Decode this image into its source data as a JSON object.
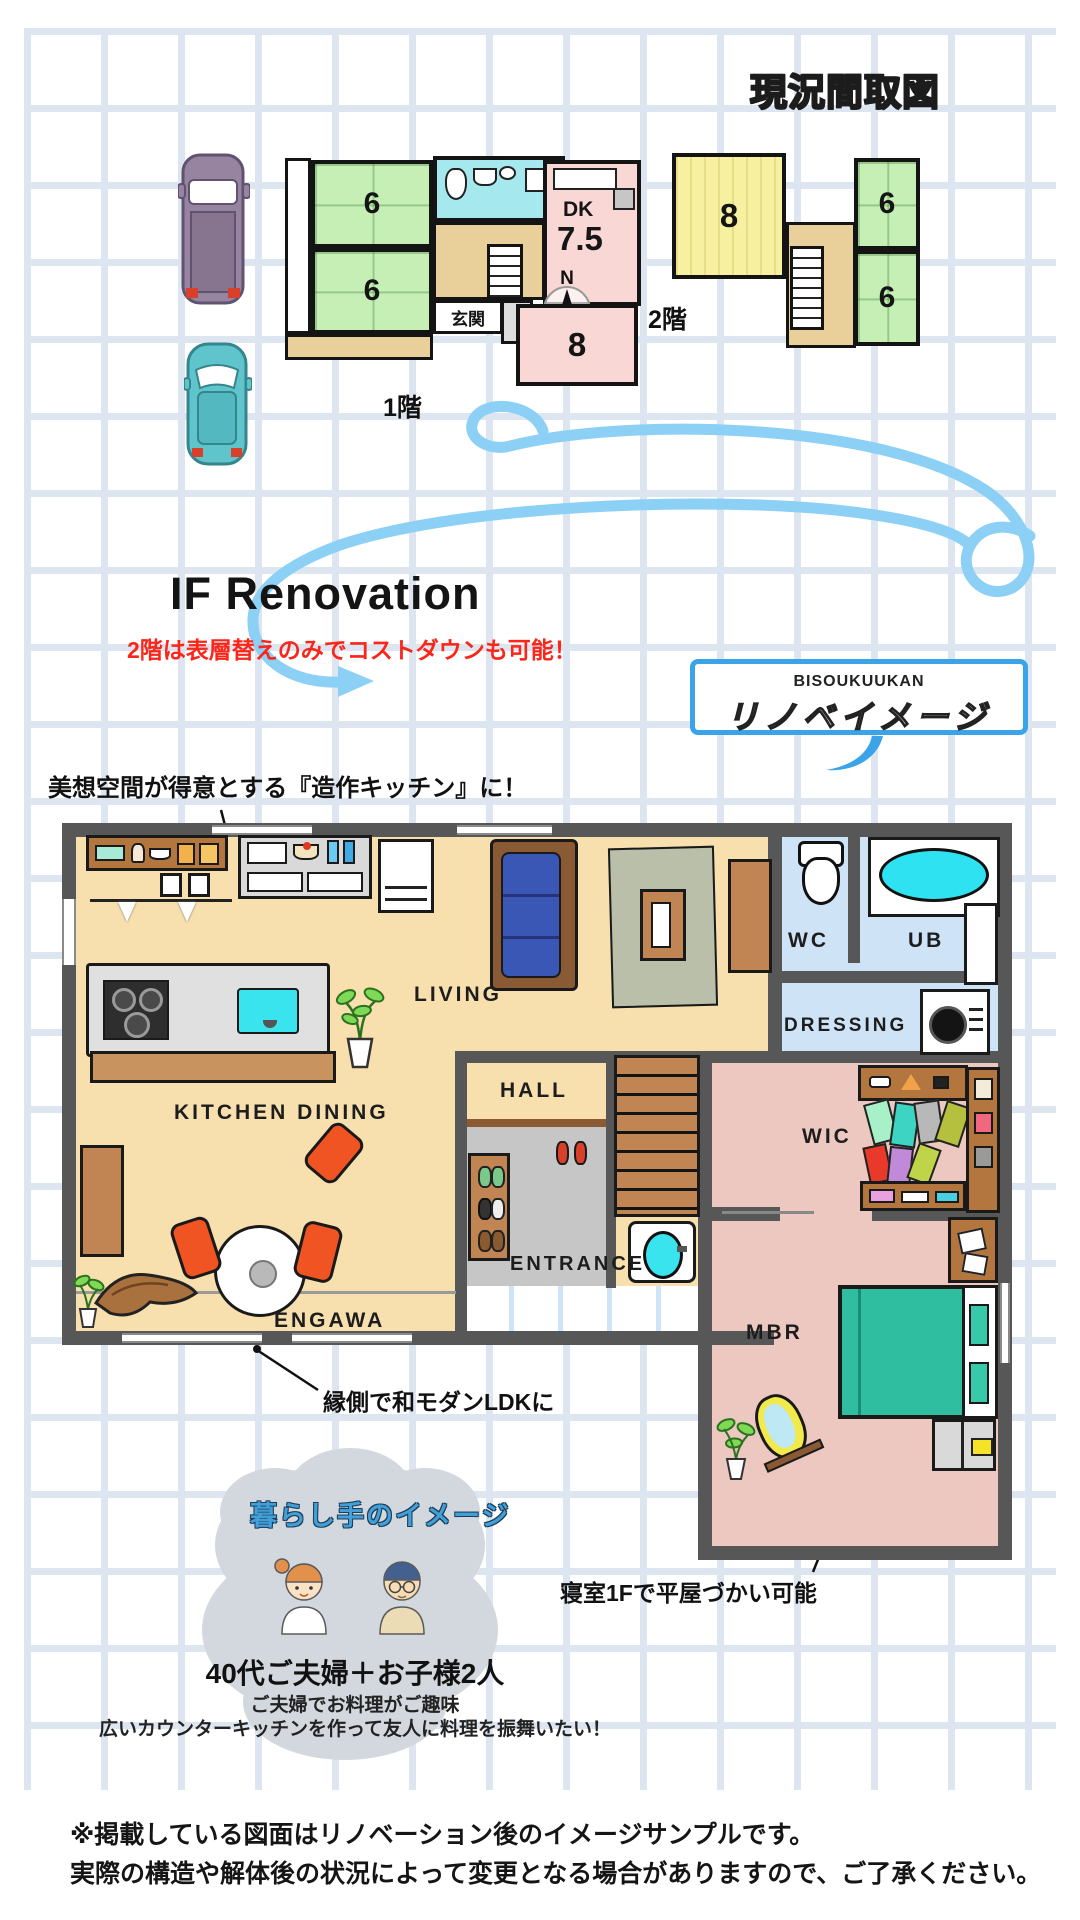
{
  "page": {
    "title": "現況間取図"
  },
  "current_plans": {
    "floor1": {
      "caption": "1階",
      "tatami_top": "6",
      "tatami_bottom": "6",
      "dk_label": "DK",
      "dk_size": "7.5",
      "washitsu8": "8",
      "genkan": "玄関"
    },
    "floor2": {
      "caption": "2階",
      "room8": "8",
      "room6_top": "6",
      "room6_bottom": "6"
    },
    "compass": "N"
  },
  "renovation_header": {
    "headline": "IF Renovation",
    "cost_note": "2階は表層替えのみでコストダウンも可能！",
    "badge_brand": "BISOUKUUKAN",
    "badge_title": "リノベイメージ"
  },
  "annotations": {
    "kitchen": "美想空間が得意とする『造作キッチン』に！",
    "engawa": "縁側で和モダンLDKに",
    "bedroom": "寝室1Fで平屋づかい可能"
  },
  "renovated_plan": {
    "living": "LIVING",
    "kitchen_dining": "KITCHEN DINING",
    "hall": "HALL",
    "entrance": "ENTRANCE",
    "engawa": "ENGAWA",
    "wc": "WC",
    "ub": "UB",
    "dressing": "DRESSING",
    "wic": "WIC",
    "mbr": "MBR"
  },
  "resident_profile": {
    "cloud_title": "暮らし手のイメージ",
    "family": "40代ご夫婦＋お子様2人",
    "hobby": "ご夫婦でお料理がご趣味",
    "wish": "広いカウンターキッチンを作って友人に料理を振舞いたい！"
  },
  "disclaimer": {
    "line1": "※掲載している図面はリノベーション後のイメージサンプルです。",
    "line2": "実際の構造や解体後の状況によって変更となる場合がありますので、ご了承ください。"
  },
  "colors": {
    "grid": "#dde6f0",
    "tatami_green": "#c5efb5",
    "bath_cyan": "#a5e9ef",
    "room_pink": "#f8d7d5",
    "room_yellow": "#f6f0a0",
    "hall_tan": "#e9cf9a",
    "wall_dark": "#575757",
    "floor_cream": "#f8dfae",
    "floor_blue": "#cfe3f6",
    "floor_pink": "#ecc8c1",
    "floor_gray": "#c6c6c6",
    "accent_blue": "#3ba4e8",
    "arrow_blue": "#8cd0f6",
    "note_red": "#fa2619",
    "bed_teal": "#2fbfa0",
    "sofa_blue": "#3b57b5",
    "chair_orange": "#f05423",
    "wood_brown": "#c08552"
  }
}
